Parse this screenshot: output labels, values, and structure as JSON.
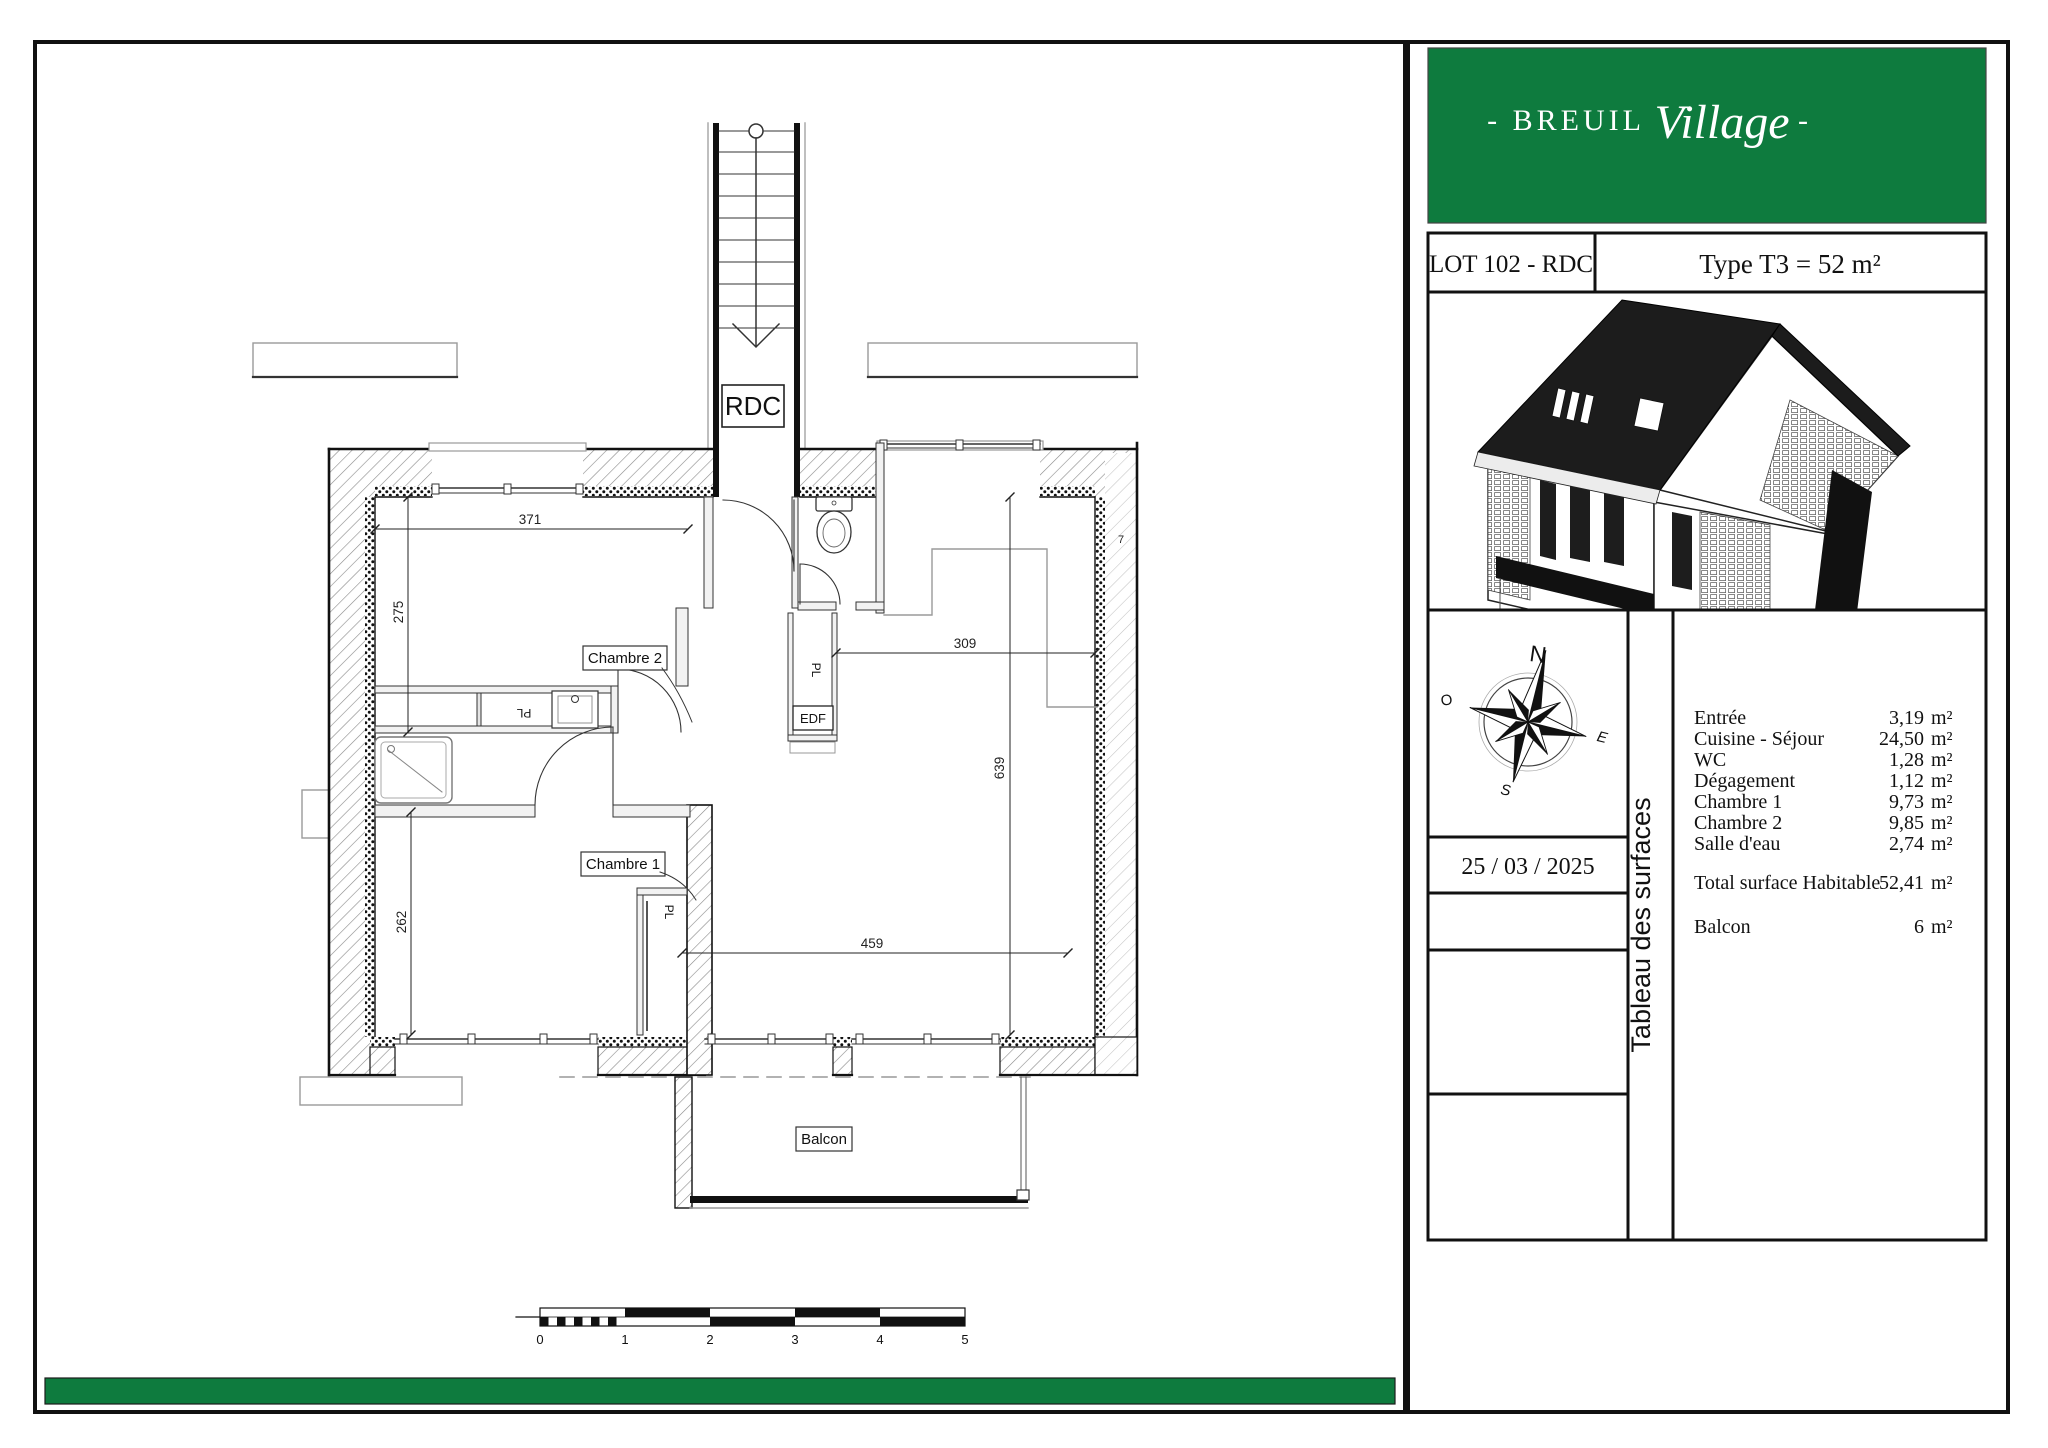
{
  "header": {
    "brand_prefix": "- BREUIL",
    "brand_script": "Village",
    "brand_suffix": "-",
    "lot": "LOT 102 - RDC",
    "type": "Type T3 = 52 m²"
  },
  "date": "25 / 03 / 2025",
  "side_strip": "Tableau des surfaces",
  "surfaces": {
    "unit": "m²",
    "rows": [
      {
        "label": "Entrée",
        "value": "3,19"
      },
      {
        "label": "Cuisine - Séjour",
        "value": "24,50"
      },
      {
        "label": "WC",
        "value": "1,28"
      },
      {
        "label": "Dégagement",
        "value": "1,12"
      },
      {
        "label": "Chambre 1",
        "value": "9,73"
      },
      {
        "label": "Chambre 2",
        "value": "9,85"
      },
      {
        "label": "Salle d'eau",
        "value": "2,74"
      }
    ],
    "total": {
      "label": "Total surface Habitable",
      "value": "52,41"
    },
    "balcony": {
      "label": "Balcon",
      "value": "6"
    }
  },
  "compass": {
    "n": "N",
    "e": "E",
    "s": "S",
    "o": "O"
  },
  "plan": {
    "rooms": {
      "chambre2": "Chambre 2",
      "chambre1": "Chambre 1",
      "balcon": "Balcon",
      "stair_level": "RDC",
      "closet": "PL",
      "edf": "EDF"
    },
    "dimensions": {
      "top": "371",
      "left_top": "275",
      "left_bottom": "262",
      "middle": "309",
      "right": "639",
      "bottom": "459",
      "partial": "7"
    }
  },
  "scale_bar": {
    "labels": [
      "0",
      "1",
      "2",
      "3",
      "4",
      "5"
    ]
  },
  "colors": {
    "brand_green": "#0E7B3E"
  }
}
